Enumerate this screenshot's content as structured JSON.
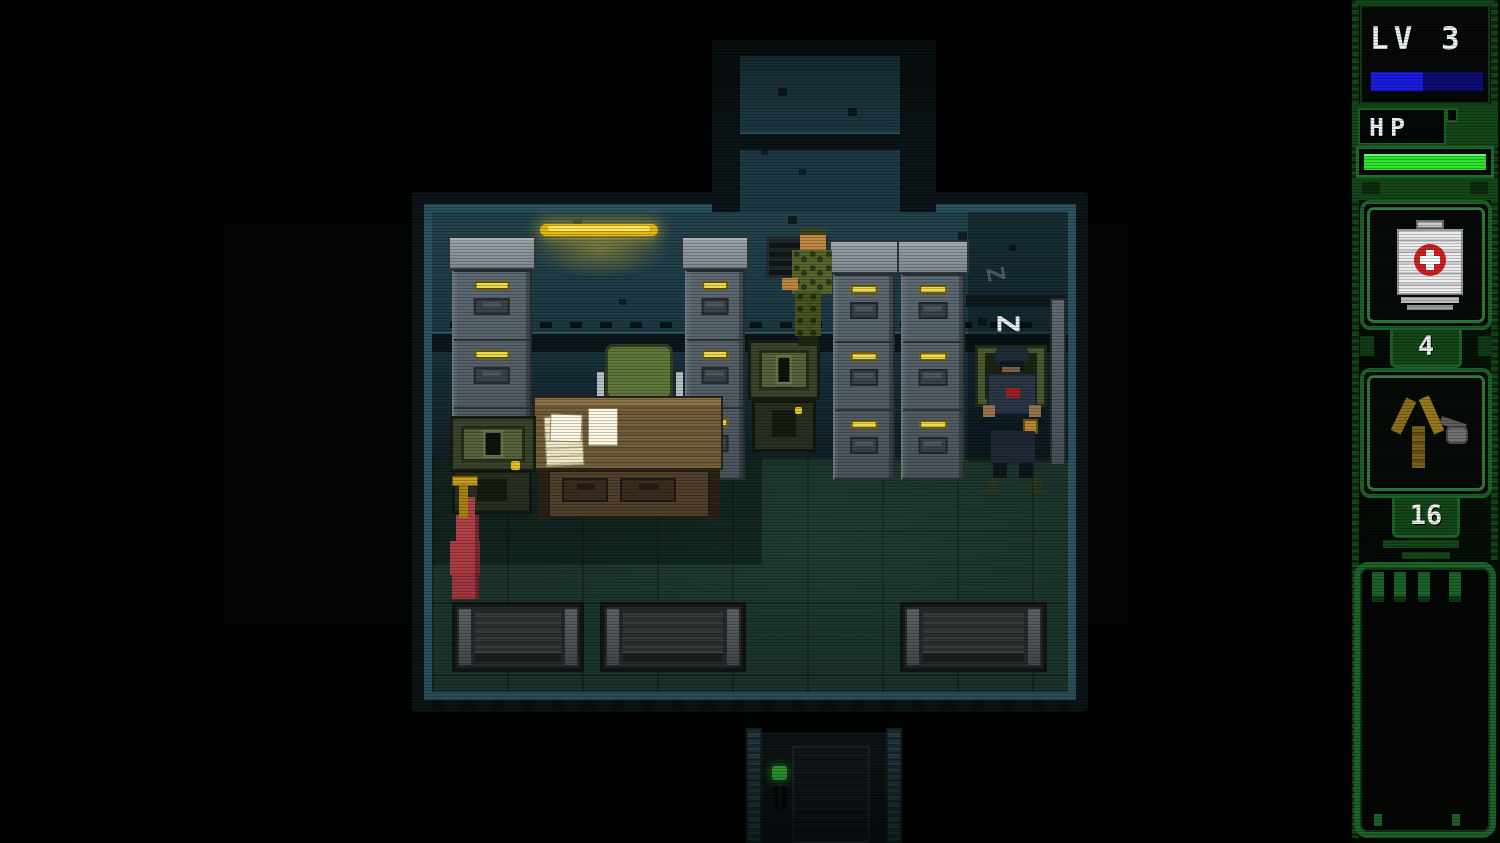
{
  "hud": {
    "level_label": "LV 3",
    "xp_bar": {
      "percent_filled": 46,
      "fill_color": "#1a1ae0",
      "empty_color": "#0c0c70"
    },
    "hp_label": "HP",
    "hp_bar": {
      "percent_filled": 97,
      "fill_color": "#2ce22c"
    },
    "items": [
      {
        "slot": 1,
        "icon": "medkit-icon",
        "count": "4"
      },
      {
        "slot": 2,
        "icon": "slingshot-icon",
        "count": "16"
      }
    ],
    "notepad": {
      "content": ""
    },
    "frame_color": "#1b6128"
  },
  "game": {
    "sleep_indicator": "Z",
    "sleep_indicator_faint": "Z",
    "door_led_color": "#38cc40",
    "lamp_color": "#ffd92e",
    "entities": [
      {
        "name": "player-soldier"
      },
      {
        "name": "sleeping-guard"
      },
      {
        "name": "filing-cabinet",
        "qty": 4
      },
      {
        "name": "office-desk"
      },
      {
        "name": "office-chair"
      },
      {
        "name": "papers",
        "qty": 2
      },
      {
        "name": "field-radio",
        "qty": 2
      },
      {
        "name": "red-cloth"
      },
      {
        "name": "wall-vent"
      },
      {
        "name": "bench",
        "qty": 3
      },
      {
        "name": "ceiling-lamp"
      },
      {
        "name": "exit-door"
      },
      {
        "name": "corridor-top"
      }
    ]
  }
}
